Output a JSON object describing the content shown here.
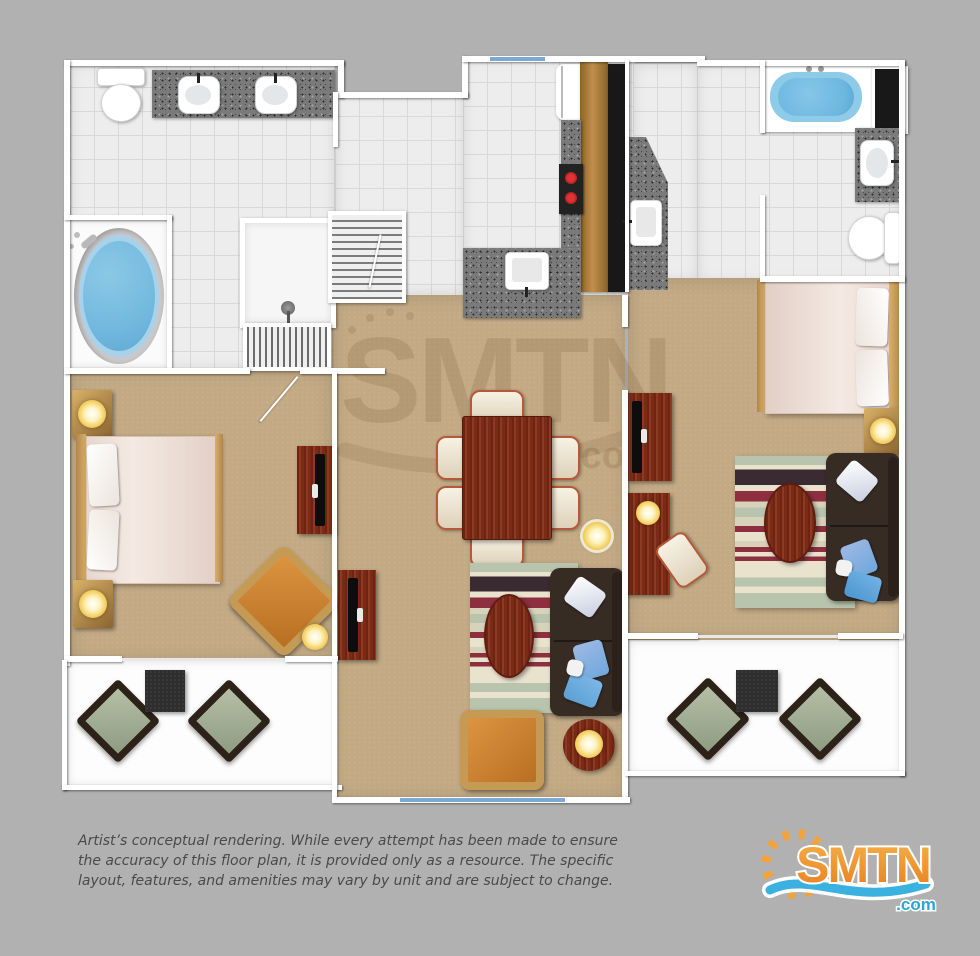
{
  "disclaimer": {
    "text": "Artist’s conceptual rendering. While every attempt has been made to ensure the accuracy of this floor plan, it is provided only as a resource. The specific layout, features, and amenities may vary by unit and are subject to change."
  },
  "watermark": {
    "brand": "SMTN",
    "suffix": ".com"
  },
  "logo": {
    "brand": "SMTN",
    "suffix": ".com",
    "colors": {
      "orange": "#f29d38",
      "orange_dark": "#e87e1e",
      "blue": "#3ab1de",
      "white": "#ffffff"
    }
  },
  "palette": {
    "background": "#b1b1b1",
    "wall": "#ffffff",
    "tile": "#ededed",
    "tile_line": "#d9d9d9",
    "carpet": "#c3aa85",
    "balcony": "#fdfdfd",
    "granite": "#7a7a7a",
    "counter_wood": "#b28144",
    "bar_black": "#181818",
    "dark_red_wood": "#7a2b16",
    "headboard_tan": "#c89b55",
    "tub_blue": "#72b9de",
    "window_blue": "#7aa9d4",
    "sofa_brown": "#372c23",
    "pillow_blue": "#6fa8dc",
    "armchair_orange": "#cd8530",
    "patio_cushion": "#9aa88f",
    "lamp_glow": "#f3cf5f",
    "rug_sage": "#b9c4ae",
    "rug_red": "#8d2f3e",
    "rug_dark": "#3a2a32"
  },
  "fixtures": [
    "toilet",
    "double-sink-vanity",
    "jacuzzi-tub",
    "shower-stall",
    "louvered-closet",
    "refrigerator",
    "stove",
    "kitchen-sink",
    "bar-counter",
    "bathtub",
    "linen-closet",
    "bed",
    "nightstand",
    "lamp",
    "dresser-tv",
    "armchair",
    "dining-table",
    "dining-chair",
    "sofa",
    "coffee-table",
    "area-rug",
    "desk",
    "desk-chair",
    "patio-chair",
    "patio-table",
    "sliding-glass-door"
  ]
}
